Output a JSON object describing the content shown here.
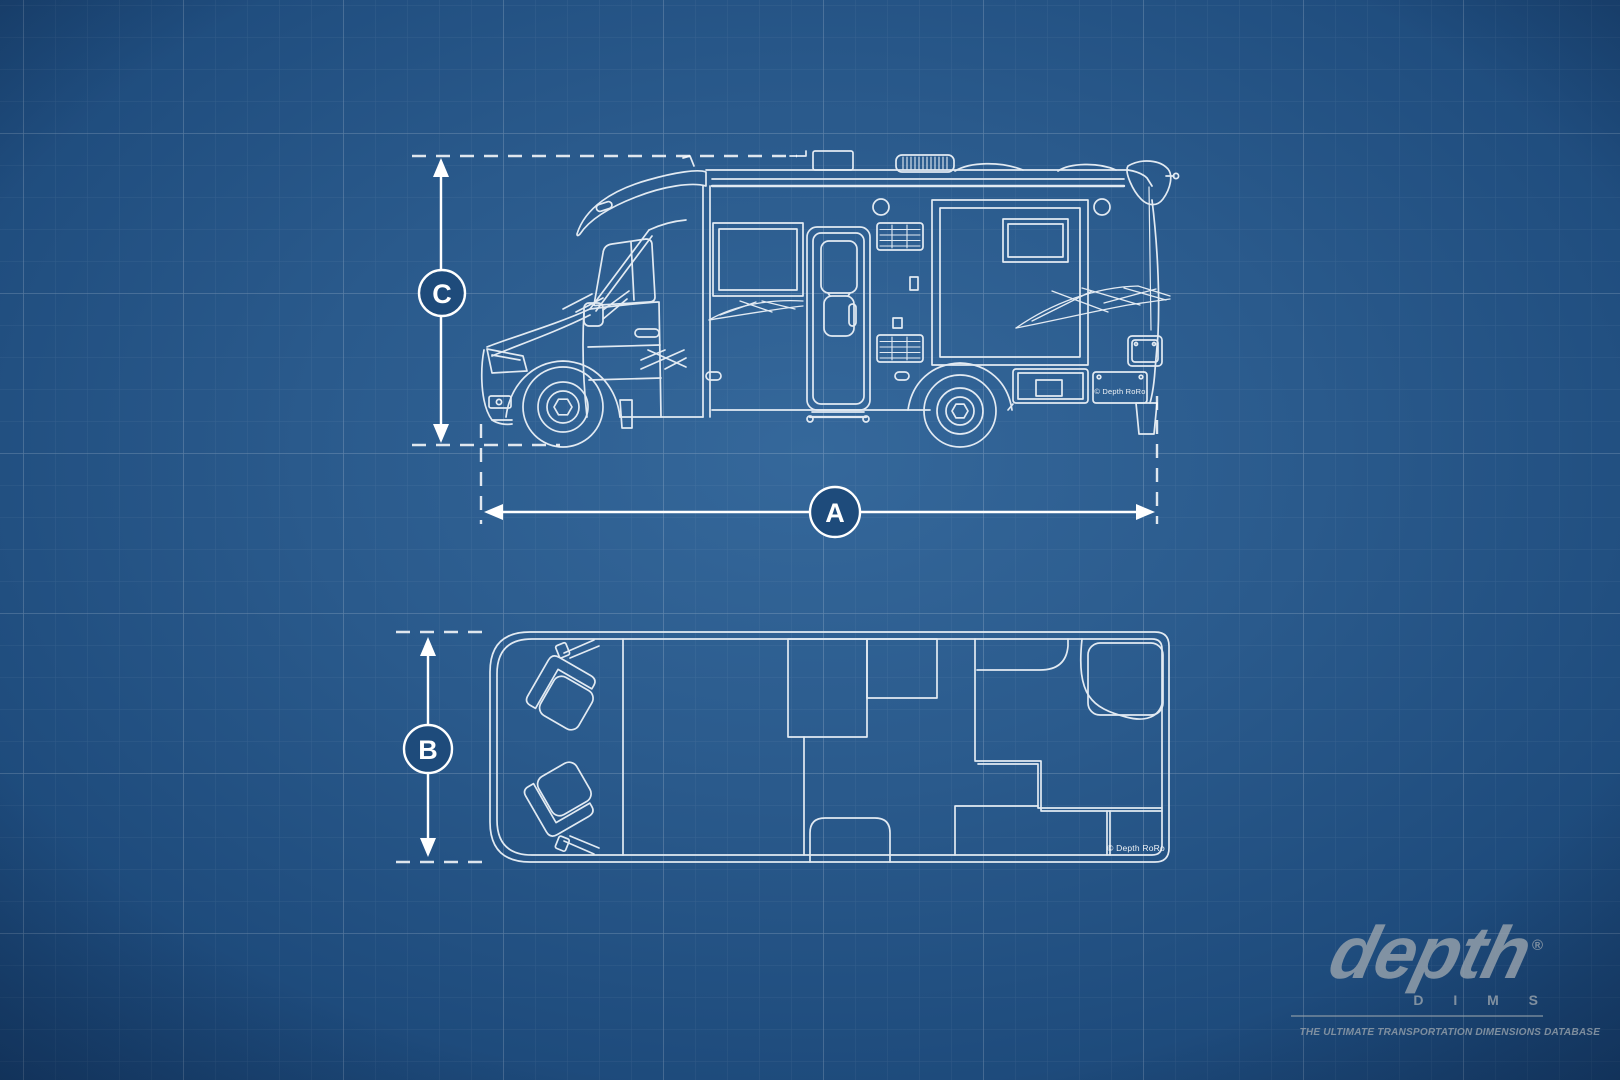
{
  "scene": {
    "description": "Blueprint drawing of a Class C camper van motorhome: side elevation above, top-down floor plan below, on a blue technical grid background",
    "views": [
      "side-elevation",
      "floor-plan"
    ]
  },
  "colors": {
    "background_center": "#33679a",
    "background_edge": "#173f6d",
    "grid_minor": "rgba(255,255,255,0.08)",
    "grid_major": "rgba(255,255,255,0.17)",
    "drawing_line": "#ecf2f8",
    "dimension_line": "#ffffff",
    "dimension_badge_fill": "#1e4b7b",
    "logo_gray": "#97a2ac"
  },
  "dimension_markers": {
    "length": "A",
    "width": "B",
    "height": "C"
  },
  "watermarks": {
    "side_view_plate": "© Depth RoRo",
    "floor_plan": "© Depth RoRo"
  },
  "logo": {
    "brand": "depth",
    "registered_mark": "®",
    "sub_brand": "D I M S",
    "tagline": "THE ULTIMATE TRANSPORTATION DIMENSIONS DATABASE"
  }
}
